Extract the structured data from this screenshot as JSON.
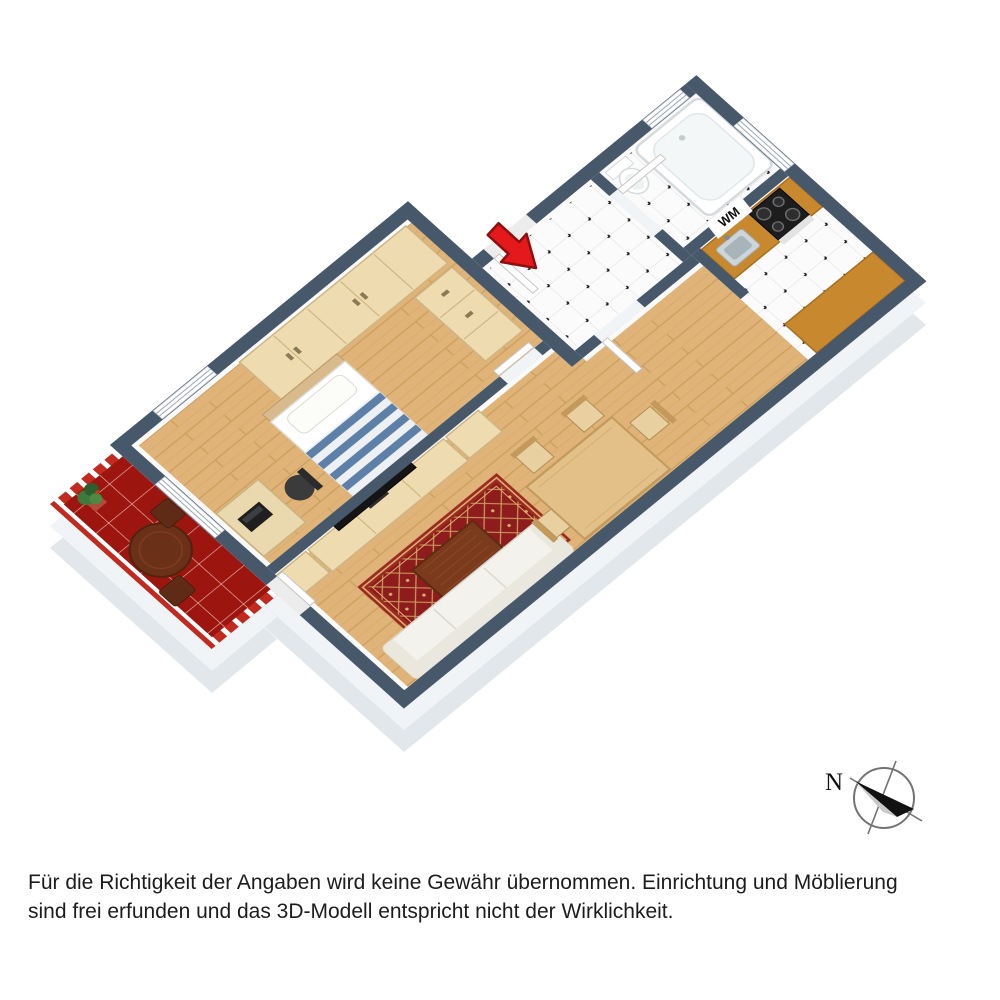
{
  "disclaimer": {
    "line1": "Für die Richtigkeit der Angaben wird keine Gewähr übernommen. Einrichtung und Möblierung",
    "line2": "sind frei erfunden und das 3D-Modell entspricht nicht der Wirklichkeit."
  },
  "plan": {
    "washer_label": "WM",
    "compass_north_label": "N"
  },
  "colors": {
    "wall_top_slate": "#47586b",
    "wall_face_white": "#ffffff",
    "wood_floor": "#e0b478",
    "white_tile": "#fbfbfb",
    "balcony_tile_red": "#9c150f",
    "kitchen_counter_wood": "#c8882e",
    "rug_red": "#8e1c1c",
    "mattress_stripe_blue": "#5d80a8",
    "entrance_arrow_red": "#e4191c",
    "furniture_light_wood": "#eedcb0"
  }
}
